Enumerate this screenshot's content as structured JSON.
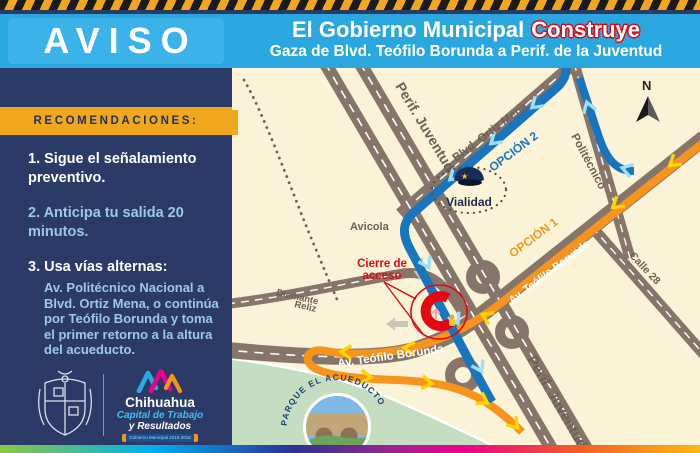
{
  "header": {
    "badge": "AVISO",
    "title_regular": "El Gobierno Municipal",
    "title_accent": "Construye",
    "subtitle": "Gaza de Blvd. Teófilo Borunda a Perif. de la Juventud"
  },
  "sidebar": {
    "banner": "RECOMENDACIONES:",
    "item1": "1. Sigue el señalamiento preventivo.",
    "item2": "2. Anticipa tu salida 20 minutos.",
    "item3_title": "3. Usa vías alternas:",
    "item3_detail": "Av. Politécnico Nacional a Blvd. Ortiz Mena, o continúa por Teófilo Borunda y toma el primer retorno a la altura del acueducto."
  },
  "logo": {
    "city": "Chihuahua",
    "slogan_line1": "Capital de Trabajo",
    "slogan_line2": "y Resultados",
    "ribbon": "Gobierno Municipal 2016-2018"
  },
  "map": {
    "north": "N",
    "labels": {
      "perif_top": "Perif. Juventud",
      "perif_bottom": "Perif. Juventud",
      "ortiz_mena": "Blvd. Ortiz Mena",
      "politecnico": "Politécnico",
      "calle28": "Calle 28",
      "borunda_ne": "Av. Teófilo Borunda",
      "borunda_west": "Av. Teófilo Borunda",
      "avicola": "Avicola",
      "diamante_line1": "Diamante",
      "diamante_line2": "Reliz",
      "vialidad": "Vialidad",
      "option1": "OPCIÓN 1",
      "option2": "OPCIÓN 2",
      "closure_line1": "Cierre de",
      "closure_line2": "acceso",
      "park": "PARQUE EL ACUEDUCTO"
    },
    "colors": {
      "route_option1": "#F7941E",
      "route_option2": "#1B75BC",
      "closure_red": "#E30613",
      "road": "#87756A",
      "background": "#FAF3D8",
      "park_green": "#C5DEC2"
    }
  },
  "theme": {
    "header_blue": "#29A7DE",
    "navy": "#2B3A67",
    "banner_yellow": "#F0A71E",
    "light_blue_text": "#9CC9E8"
  }
}
